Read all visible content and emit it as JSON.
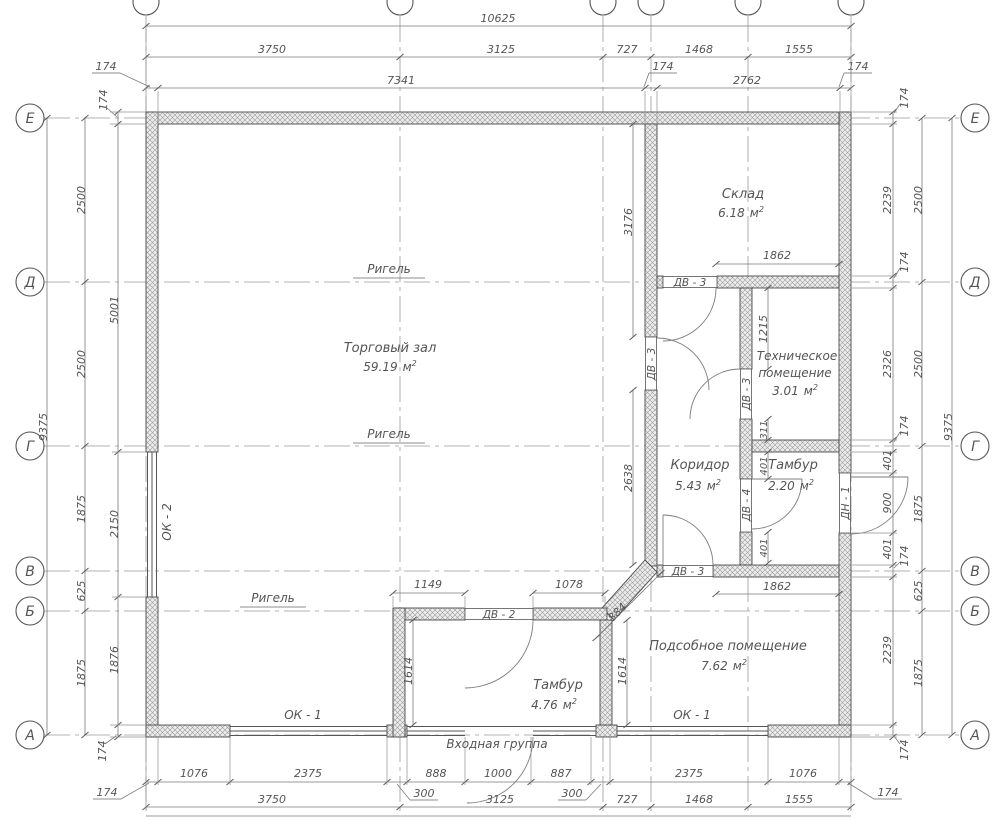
{
  "colors": {
    "wall_outline": "#4a4a4a",
    "hatch": "#9a9a9a",
    "dim_line": "#7a7a7a",
    "text": "#555555",
    "background": "#ffffff"
  },
  "axes": {
    "rows": [
      "Е",
      "Д",
      "Г",
      "В",
      "Б",
      "А"
    ]
  },
  "unit": {
    "m": "м",
    "sup": "2"
  },
  "rooms": {
    "torg": {
      "name": "Торговый зал",
      "area": "59.19"
    },
    "sklad": {
      "name": "Склад",
      "area": "6.18"
    },
    "teh": {
      "name1": "Техническое",
      "name2": "помещение",
      "area": "3.01"
    },
    "kor": {
      "name": "Коридор",
      "area": "5.43"
    },
    "tambur2": {
      "name": "Тамбур",
      "area": "2.20"
    },
    "podsob": {
      "name": "Подсобное помещение",
      "area": "7.62"
    },
    "tambur4": {
      "name": "Тамбур",
      "area": "4.76"
    }
  },
  "labels": {
    "rigel": "Ригель",
    "entrance": "Входная группа",
    "ok1": "ОК - 1",
    "ok2": "ОК - 2",
    "dv2": "ДВ - 2",
    "dv3": "ДВ - 3",
    "dv4": "ДВ - 4",
    "dn1": "ДН - 1"
  },
  "dims": {
    "top1": "10625",
    "top2": [
      "3750",
      "3125",
      "727",
      "1468",
      "1555"
    ],
    "top3": [
      "174",
      "7341",
      "174",
      "2762",
      "174"
    ],
    "left_outer": "9375",
    "left_grid": [
      "2500",
      "2500",
      "1875",
      "625",
      "1875"
    ],
    "left_inner": [
      "174",
      "5001",
      "2150",
      "1876",
      "174"
    ],
    "right_outer": "9375",
    "right_grid": [
      "2500",
      "2500",
      "1875",
      "625",
      "1875"
    ],
    "right_inner": [
      "174",
      "2239",
      "174",
      "2326",
      "174",
      "401",
      "900",
      "401",
      "174",
      "2239",
      "174"
    ],
    "bottom1": [
      "174",
      "1076",
      "2375",
      "300",
      "888",
      "1000",
      "887",
      "300",
      "2375",
      "1076",
      "174"
    ],
    "bottom2": [
      "3750",
      "3125",
      "727",
      "1468",
      "1555"
    ],
    "interior": {
      "v3176": "3176",
      "v2638": "2638",
      "h1862a": "1862",
      "v1215": "1215",
      "v311": "311",
      "v401a": "401",
      "v401b": "401",
      "h1862b": "1862",
      "diag884": "884",
      "h1149": "1149",
      "h1078": "1078",
      "v1614a": "1614",
      "v1614b": "1614"
    }
  }
}
